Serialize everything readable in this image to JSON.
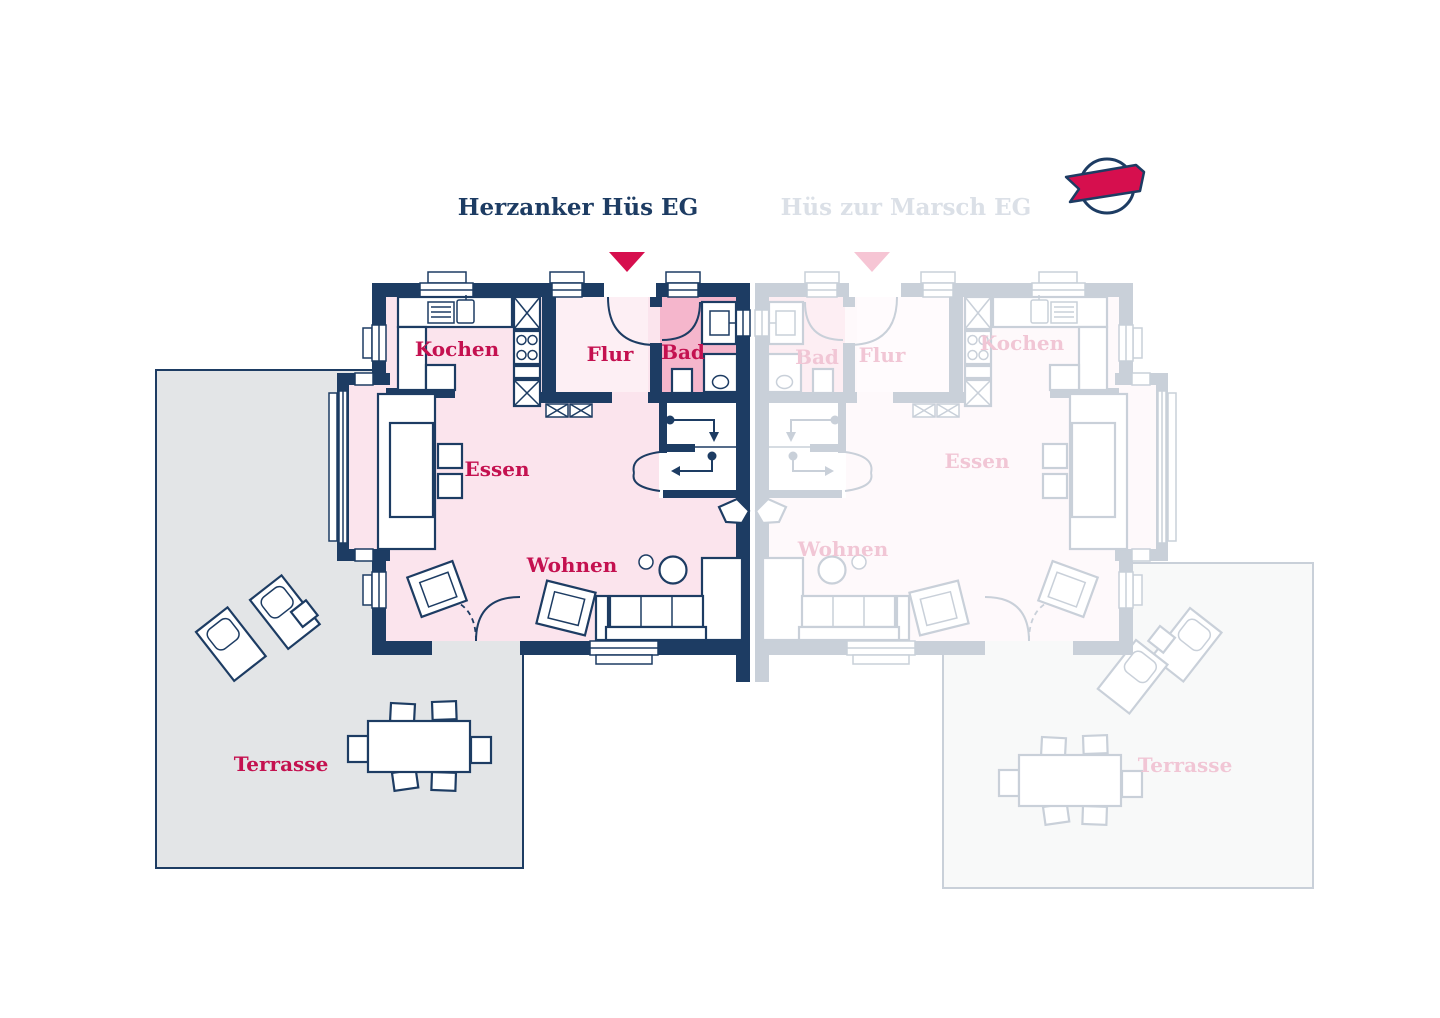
{
  "tabs": {
    "active_label": "Herzanker Hüs EG",
    "inactive_label": "Hüs zur Marsch EG"
  },
  "logo": {
    "name": "circle-ribbon-logo"
  },
  "colors": {
    "wall_navy": "#1d3c63",
    "room_label_crimson": "#c41150",
    "marker_red": "#d60f4e",
    "room_pink": "#fbe4ed",
    "flur_pink": "#fdeff4",
    "bad_pink": "#f5b6cc",
    "terrace_gray": "#e3e5e7",
    "inactive_title_gray": "#dbe0e7",
    "inactive_marker_pink": "#f6c5d4"
  },
  "plans": {
    "herzanker": {
      "title": "Herzanker Hüs EG",
      "state": "active",
      "rooms": {
        "kochen": "Kochen",
        "flur": "Flur",
        "bad": "Bad",
        "essen": "Essen",
        "wohnen": "Wohnen",
        "terrasse": "Terrasse"
      }
    },
    "marsch": {
      "title": "Hüs zur Marsch EG",
      "state": "inactive",
      "rooms": {
        "kochen": "Kochen",
        "flur": "Flur",
        "bad": "Bad",
        "essen": "Essen",
        "wohnen": "Wohnen",
        "terrasse": "Terrasse"
      }
    }
  }
}
